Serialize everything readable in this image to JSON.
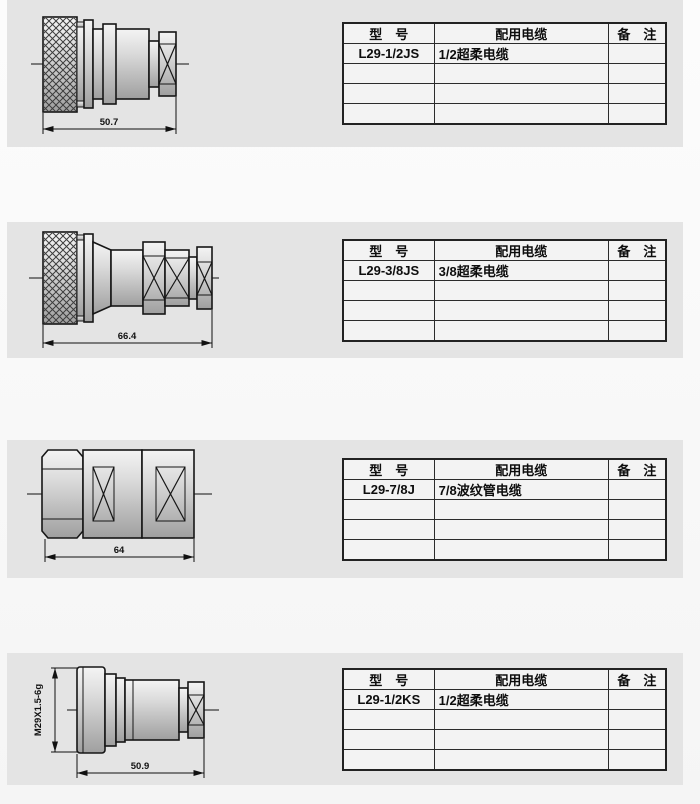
{
  "page": {
    "background": "#f7f7f7",
    "panel_background": "#e4e4e4",
    "table_background": "#f3f3f3",
    "line_color": "#161616"
  },
  "table_headers": {
    "model": "型　号",
    "cable": "配用电缆",
    "remark": "备　注"
  },
  "sections": [
    {
      "drawing": {
        "kind": "straight-plug-knurled-coupling-nut",
        "length_label": "50.7"
      },
      "table": {
        "model": "L29-1/2JS",
        "cable": "1/2超柔电缆",
        "remark": ""
      }
    },
    {
      "drawing": {
        "kind": "straight-plug-knurled-coupling-nut-long",
        "length_label": "66.4"
      },
      "table": {
        "model": "L29-3/8JS",
        "cable": "3/8超柔电缆",
        "remark": ""
      }
    },
    {
      "drawing": {
        "kind": "straight-plug-hex-coupling-nut",
        "length_label": "64"
      },
      "table": {
        "model": "L29-7/8J",
        "cable": "7/8波纹管电缆",
        "remark": ""
      }
    },
    {
      "drawing": {
        "kind": "threaded-jack",
        "length_label": "50.9",
        "thread_label": "M29X1.5-6g"
      },
      "table": {
        "model": "L29-1/2KS",
        "cable": "1/2超柔电缆",
        "remark": ""
      }
    }
  ]
}
